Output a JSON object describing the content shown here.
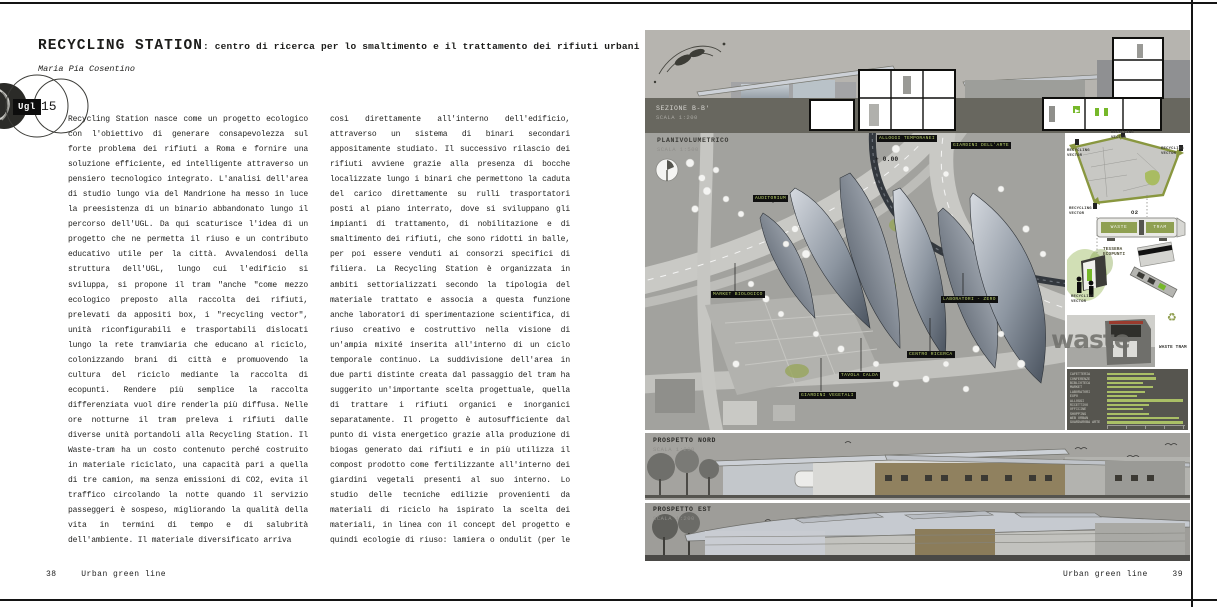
{
  "page_left": {
    "title": "RECYCLING STATION",
    "subtitle": ": centro di ricerca per lo smaltimento e il trattamento dei rifiuti urbani",
    "author": "Maria Pia Cosentino",
    "badge": {
      "label": "Ugl",
      "number": "15"
    },
    "column1": "Recycling Station nasce come un progetto ecologico con l'obiettivo di generare consapevolezza sul forte problema dei rifiuti a Roma e fornire una soluzione efficiente, ed intelligente attraverso un pensiero tecnologico integrato. L'analisi dell'area di studio lungo via del Mandrione ha messo in luce la preesistenza di un binario abbandonato lungo il percorso dell'UGL. Da qui scaturisce l'idea di un progetto che ne permetta il riuso e un contributo educativo utile per la città. Avvalendosi della struttura dell'UGL, lungo cui l'edificio si sviluppa, si propone il tram \"anche \"come mezzo ecologico preposto alla raccolta dei rifiuti, prelevati da appositi box, i \"recycling vector\", unità riconfigurabili e trasportabili dislocati lungo la rete tramviaria che educano al riciclo, colonizzando brani di città e promuovendo la cultura del riciclo mediante la raccolta di ecopunti. Rendere più semplice la raccolta differenziata vuol dire renderla più diffusa. Nelle ore notturne il tram preleva i rifiuti dalle diverse unità portandoli alla Recycling Station. Il Waste-tram ha un costo contenuto perché costruito in materiale riciclato, una capacità pari a quella di tre camion, ma senza emissioni di CO2, evita il traffico circolando la notte quando il servizio passeggeri è sospeso, migliorando la qualità della vita in termini di tempo e di salubrità dell'ambiente. Il materiale diversificato arriva",
    "column2": "così direttamente all'interno dell'edificio, attraverso un sistema di binari secondari appositamente studiato. Il successivo rilascio dei rifiuti avviene grazie alla presenza di bocche localizzate lungo i binari che permettono la caduta del carico direttamente su rulli trasportatori posti al piano interrato, dove si sviluppano gli impianti di trattamento, di nobilitazione e di smaltimento dei rifiuti, che sono ridotti in balle, per poi essere venduti ai consorzi specifici di filiera. La Recycling Station è organizzata in ambiti settorializzati secondo la tipologia del materiale trattato e associa a questa funzione anche laboratori di sperimentazione scientifica, di riuso creativo e costruttivo nella visione di un'ampia mixité inserita all'interno di un ciclo temporale continuo. La suddivisione dell'area in due parti distinte creata dal passaggio del tram ha suggerito un'importante scelta progettuale, quella di trattare i rifiuti organici e inorganici separatamente. Il progetto è autosufficiente dal punto di vista energetico grazie alla produzione di biogas generato dai rifiuti e in più utilizza il compost prodotto come fertilizzante all'interno dei giardini vegetali presenti al suo interno. Lo studio delle tecniche edilizie provenienti da materiali di riciclo ha ispirato la scelta dei materiali, in linea con il concept del progetto e quindi ecologie di riuso: lamiera o ondulit (per le coperture), legno (per i",
    "footer": {
      "page_number": "38",
      "running_title": "Urban green line"
    }
  },
  "page_right": {
    "section": {
      "label": "SEZIONE B-B'",
      "scale": "SCALA 1:200"
    },
    "plan": {
      "label": "PLANIVOLUMETRICO",
      "scale": "SCALA 1:500",
      "level_mark": "+ 0.00",
      "labels": [
        "ALLOGGI TEMPORANEI",
        "GIARDINI DELL'ARTE",
        "AUDITORIUM",
        "MARKET BIOLOGICO",
        "LABORATORI - ZERO",
        "CENTRO RICERCA",
        "TAVOLA CALDA",
        "GIARDINI VEGETALI"
      ]
    },
    "sidebar": {
      "vector_label": "RECYCLING VECTOR",
      "tram_diagram": {
        "gas": "O2",
        "left": "WASTE",
        "right": "TRAM"
      },
      "card_label": "TESSERA ECOPUNTI",
      "kiosk_label": "RECYCLING VECTOR",
      "tram_photo_text": "waste",
      "tram_photo_label": "WASTE TRAM",
      "recycle_symbol": "♻"
    },
    "north_elevation": {
      "label": "PROSPETTO NORD",
      "scale": "SCALA 1:200"
    },
    "east_elevation": {
      "label": "PROSPETTO EST",
      "scale": "SCALA 1:200"
    },
    "footer": {
      "running_title": "Urban green line",
      "page_number": "39"
    }
  },
  "chart_data": {
    "type": "bar",
    "orientation": "horizontal",
    "title": "",
    "categories": [
      "CAFETTERIA",
      "CONFERENZE",
      "BIBLIOTECA",
      "MARKET",
      "LABORATORI",
      "EXPO",
      "ALLOGGI",
      "RICETTIVO",
      "OFFICINE",
      "SHOPPING",
      "WEB URBAN",
      "GUARDAROBA ARTE"
    ],
    "values": [
      62,
      65,
      48,
      60,
      50,
      40,
      100,
      55,
      47,
      55,
      95,
      100
    ],
    "xlim": [
      0,
      100
    ],
    "bar_color": "#aabf66",
    "background": "#56554f",
    "legend": "none"
  }
}
